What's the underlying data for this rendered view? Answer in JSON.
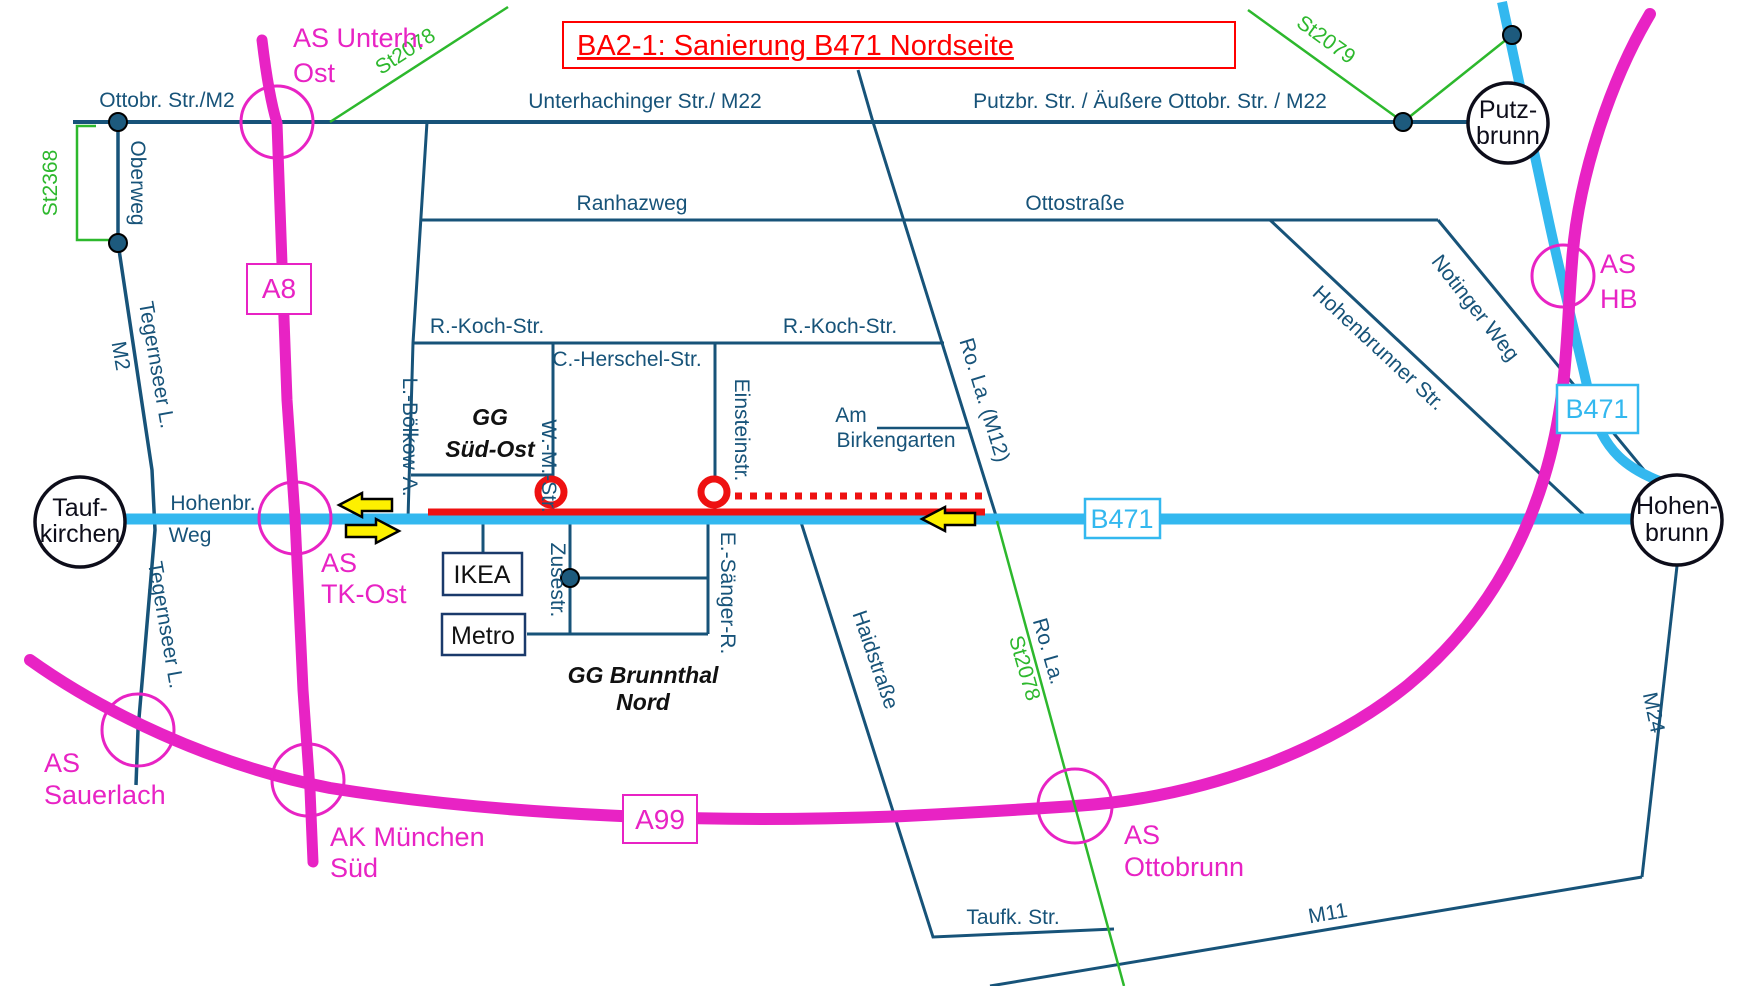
{
  "title": "BA2-1: Sanierung B471 Nordseite",
  "motorways": {
    "a8": "A8",
    "a99": "A99",
    "b471": "B471"
  },
  "towns": {
    "taufkirchen": [
      "Tauf-",
      "kirchen"
    ],
    "putzbrunn": [
      "Putz-",
      "brunn"
    ],
    "hohenbrunn": [
      "Hohen-",
      "brunn"
    ]
  },
  "interchanges": {
    "unterhaching_ost": [
      "AS Unterh.",
      "Ost"
    ],
    "tk_ost": [
      "AS",
      "TK-Ost"
    ],
    "hb": [
      "AS",
      "HB"
    ],
    "sauerlach": [
      "AS",
      "Sauerlach"
    ],
    "ak_muenchen_sued": [
      "AK München",
      "Süd"
    ],
    "ottobrunn": [
      "AS",
      "Ottobrunn"
    ]
  },
  "streets": {
    "ottobr_m2": "Ottobr. Str./M2",
    "oberweg": "Oberweg",
    "unterhachinger": "Unterhachinger  Str./ M22",
    "putzbr": "Putzbr.  Str. / Äußere Ottobr. Str. / M22",
    "ranhazweg": "Ranhazweg",
    "ottostrasse": "Ottostraße",
    "rkoch_w": "R.-Koch-Str.",
    "rkoch_e": "R.-Koch-Str.",
    "herschel": "C.-Herschel-Str.",
    "boelkow": "L.-Bölkow-A.",
    "wm": "W.-M.-Str.",
    "einstein": "Einsteinstr.",
    "zuse": "Zusestr.",
    "saenger": "E.-Sänger-R.",
    "am": "Am",
    "birkengarten": "Birkengarten",
    "ro_la_m12": "Ro. La. (M12)",
    "ro_la": "Ro. La.",
    "hohenbrunner": "Hohenbrunner Str.",
    "notinger": "Notinger Weg",
    "haidstrasse": "Haidstraße",
    "taufk": "Taufk.  Str.",
    "m11": "M11",
    "m24": "M24",
    "tegernseer_n": "Tegernseer  L.",
    "tegernseer_m2": "M2",
    "tegernseer_s": "Tegernseer L.",
    "hohenbr": "Hohenbr.",
    "weg": "Weg"
  },
  "state_roads": {
    "st2368": "St2368",
    "st2078_nw": "St2078",
    "st2079": "St2079",
    "st2078_se": "St2078"
  },
  "districts": {
    "gg_sued_ost": [
      "GG",
      "Süd-Ost"
    ],
    "gg_brunnthal_nord": [
      "GG Brunnthal",
      "Nord"
    ]
  },
  "pois": {
    "ikea": "IKEA",
    "metro": "Metro"
  },
  "colors": {
    "street": "#175379",
    "b471": "#33b8ef",
    "motorway": "#e823c4",
    "state_road": "#2db82d",
    "construction": "#ee1111",
    "arrow_fill": "#fdf000",
    "title": "#ff0000"
  }
}
